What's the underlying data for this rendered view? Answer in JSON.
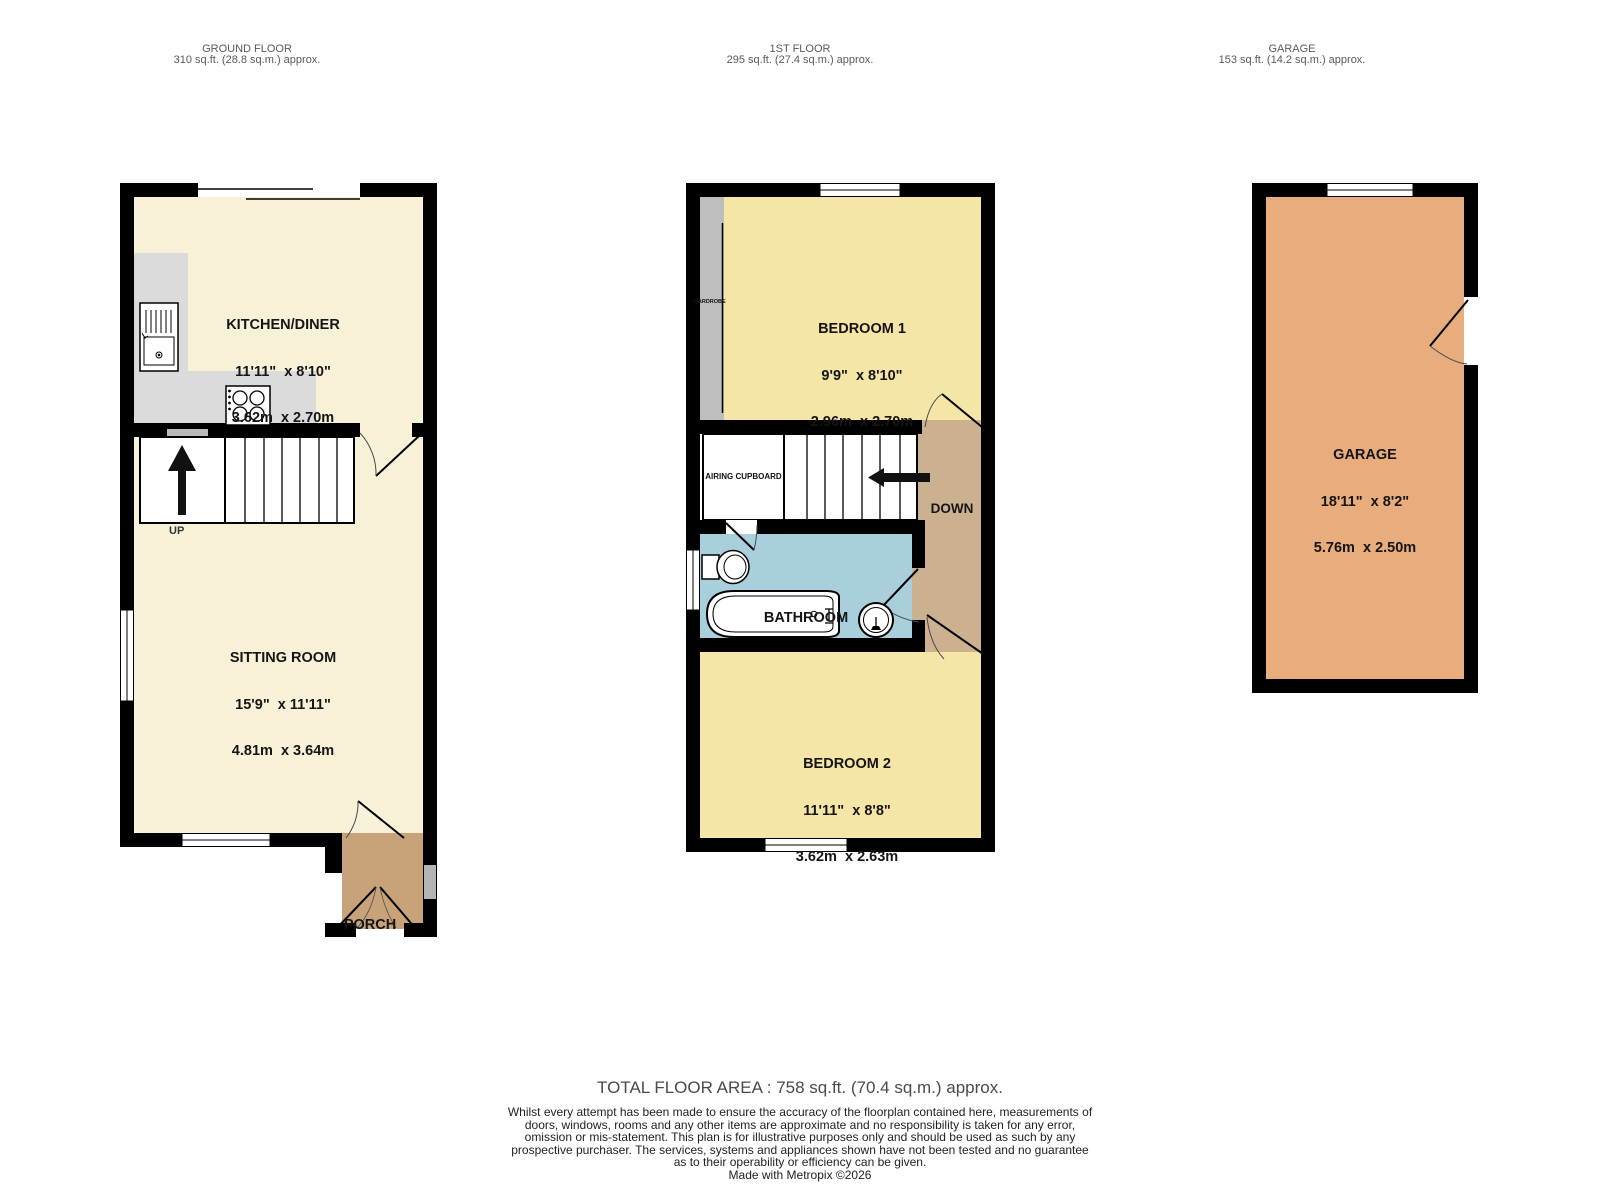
{
  "floors": {
    "ground": {
      "header_title": "GROUND FLOOR",
      "header_area": "310 sq.ft. (28.8 sq.m.) approx.",
      "rooms": {
        "kitchen": {
          "name": "KITCHEN/DINER",
          "imperial": "11'11\"  x 8'10\"",
          "metric": "3.62m  x 2.70m"
        },
        "sitting": {
          "name": "SITTING ROOM",
          "imperial": "15'9\"  x 11'11\"",
          "metric": "4.81m  x 3.64m"
        },
        "porch": {
          "name": "PORCH"
        }
      },
      "labels": {
        "up": "UP"
      }
    },
    "first": {
      "header_title": "1ST FLOOR",
      "header_area": "295 sq.ft. (27.4 sq.m.) approx.",
      "rooms": {
        "bedroom1": {
          "name": "BEDROOM 1",
          "imperial": "9'9\"  x 8'10\"",
          "metric": "2.96m  x 2.70m"
        },
        "bedroom2": {
          "name": "BEDROOM 2",
          "imperial": "11'11\"  x 8'8\"",
          "metric": "3.62m  x 2.63m"
        },
        "bathroom": {
          "name": "BATHROOM"
        },
        "landing": {
          "name": "LANDING"
        },
        "airing_cupboard": {
          "name": "AIRING CUPBOARD"
        },
        "wardrobe": {
          "name": "WARDROBE"
        }
      },
      "labels": {
        "down": "DOWN"
      }
    },
    "garage": {
      "header_title": "GARAGE",
      "header_area": "153 sq.ft. (14.2 sq.m.) approx.",
      "rooms": {
        "garage": {
          "name": "GARAGE",
          "imperial": "18'11\"  x 8'2\"",
          "metric": "5.76m  x 2.50m"
        }
      }
    }
  },
  "footer": {
    "total": "TOTAL FLOOR AREA : 758 sq.ft. (70.4 sq.m.) approx.",
    "disclaimer": "Whilst every attempt has been made to ensure the accuracy of the floorplan contained here, measurements of doors, windows, rooms and any other items are approximate and no responsibility is taken for any error, omission or mis-statement. This plan is for illustrative purposes only and should be used as such by any prospective purchaser. The services, systems and appliances shown have not been tested and no guarantee as to their operability or efficiency can be given.",
    "credit": "Made with Metropix ©2026"
  },
  "colors": {
    "wall": "#000000",
    "cream_room": "#F7F1D8",
    "yellow_room": "#F5E5A7",
    "bathroom_blue": "#A9CFDC",
    "landing_tan": "#CBB190",
    "porch_brown": "#C8A279",
    "garage_orange": "#E8AC7D",
    "counter_gray": "#DBDBDB",
    "wardrobe_gray": "#BEBEBE"
  }
}
